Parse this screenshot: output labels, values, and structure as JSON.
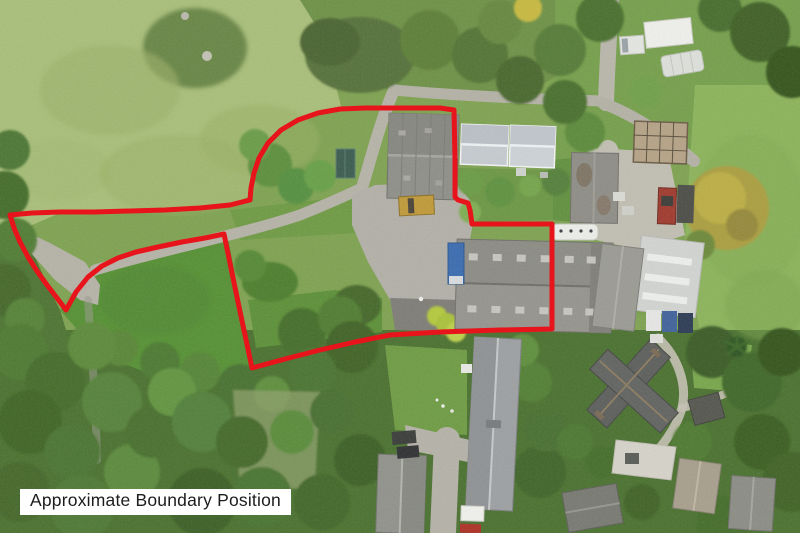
{
  "overlay": {
    "label_text": "Approximate Boundary Position",
    "label_bg": "#ffffff",
    "label_text_color": "#1c1c1c",
    "boundary": {
      "color": "#e8141b",
      "stroke_width": 5,
      "points": [
        [
          10,
          215
        ],
        [
          14,
          228
        ],
        [
          20,
          242
        ],
        [
          28,
          257
        ],
        [
          37,
          271
        ],
        [
          47,
          285
        ],
        [
          57,
          298
        ],
        [
          66,
          310
        ],
        [
          76,
          292
        ],
        [
          88,
          277
        ],
        [
          102,
          266
        ],
        [
          118,
          258
        ],
        [
          136,
          252
        ],
        [
          158,
          247
        ],
        [
          182,
          242
        ],
        [
          205,
          238
        ],
        [
          224,
          234
        ],
        [
          231,
          268
        ],
        [
          238,
          302
        ],
        [
          245,
          335
        ],
        [
          252,
          368
        ],
        [
          285,
          359
        ],
        [
          320,
          350
        ],
        [
          355,
          342
        ],
        [
          390,
          335
        ],
        [
          440,
          332
        ],
        [
          500,
          330
        ],
        [
          552,
          329
        ],
        [
          552,
          290
        ],
        [
          552,
          255
        ],
        [
          552,
          224
        ],
        [
          510,
          224
        ],
        [
          472,
          224
        ],
        [
          470,
          210
        ],
        [
          468,
          203
        ],
        [
          458,
          200
        ],
        [
          455,
          197
        ],
        [
          455,
          160
        ],
        [
          454,
          110
        ],
        [
          440,
          108
        ],
        [
          400,
          108
        ],
        [
          365,
          108
        ],
        [
          340,
          109
        ],
        [
          318,
          113
        ],
        [
          298,
          120
        ],
        [
          281,
          130
        ],
        [
          268,
          143
        ],
        [
          259,
          158
        ],
        [
          254,
          173
        ],
        [
          251,
          188
        ],
        [
          250,
          200
        ],
        [
          230,
          205
        ],
        [
          200,
          208
        ],
        [
          165,
          210
        ],
        [
          130,
          211
        ],
        [
          95,
          212
        ],
        [
          60,
          212
        ],
        [
          32,
          213
        ]
      ]
    }
  },
  "scene": {
    "palette": {
      "field_pale": "#a9bf7a",
      "field_bright": "#569134",
      "field_right": "#8cb45b",
      "woodland_dark": "#4b7230",
      "track_gray": "#b6b3a8",
      "yard_concrete": "#b2b0a7",
      "barn_roof_gray": "#8f8f89",
      "cottage_roof_light": "#cdd2d6",
      "caravan_white": "#eceee9",
      "truck_blue": "#3b6cb0",
      "machine_yellow": "#c09a39",
      "tractor_red": "#a03a2e",
      "farmhouse_roof_dark": "#5d5f5c",
      "conifer_gold": "#ab9e3f"
    }
  }
}
